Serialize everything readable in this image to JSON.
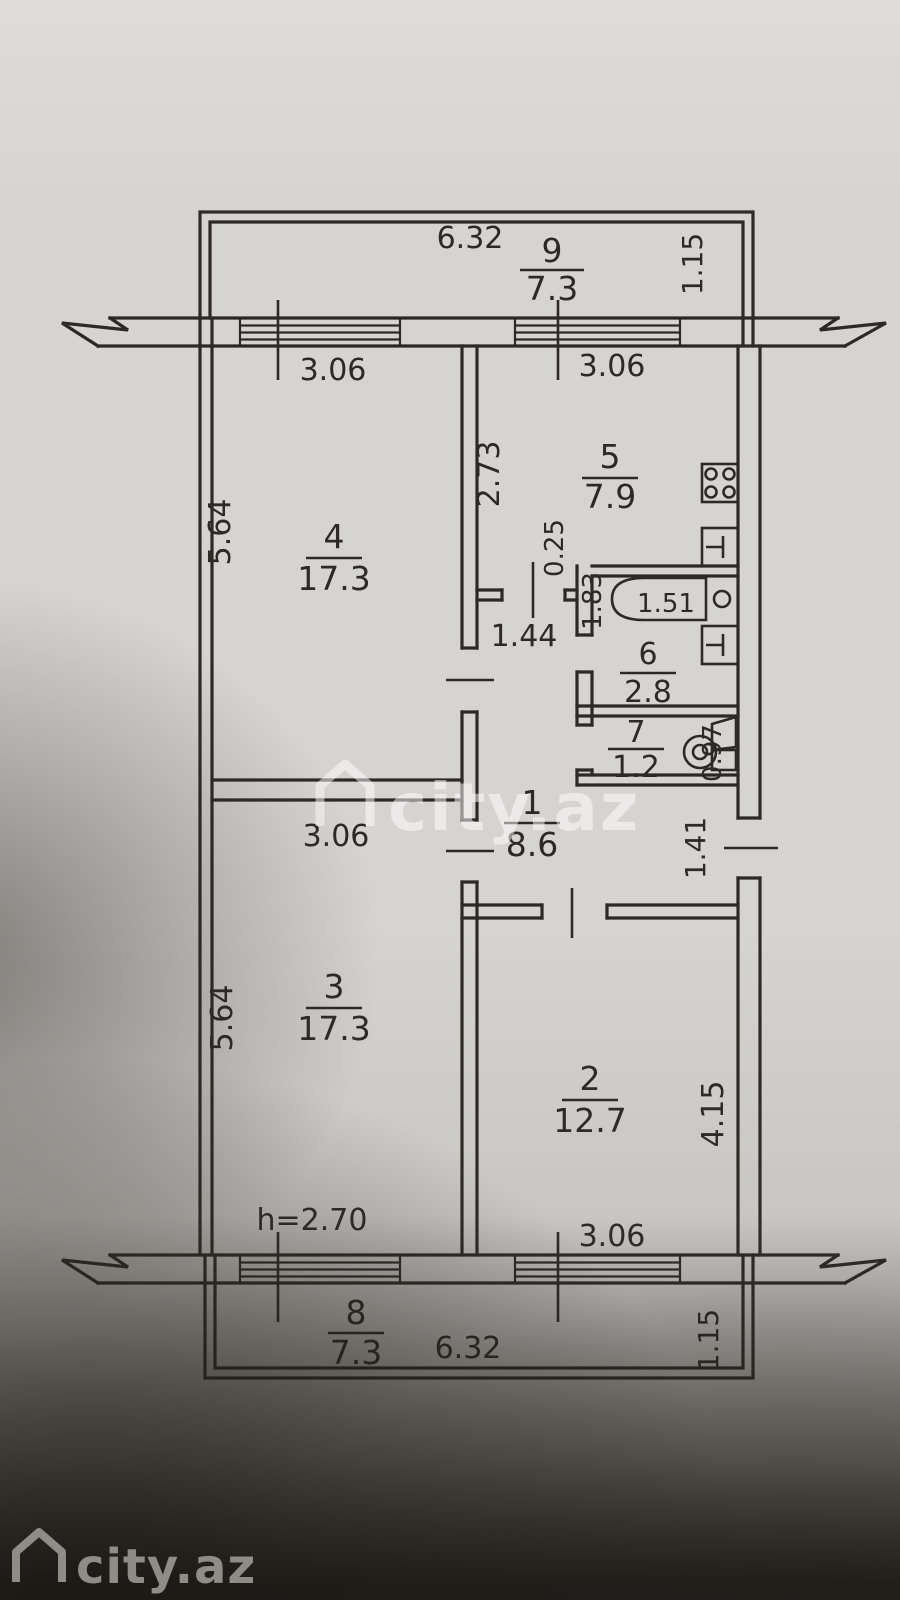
{
  "watermark": {
    "center": "city.az",
    "footer": "city.az"
  },
  "plan": {
    "ceiling_height": "h=2.70",
    "rooms": [
      {
        "no": "1",
        "area": "8.6"
      },
      {
        "no": "2",
        "area": "12.7"
      },
      {
        "no": "3",
        "area": "17.3"
      },
      {
        "no": "4",
        "area": "17.3"
      },
      {
        "no": "5",
        "area": "7.9"
      },
      {
        "no": "6",
        "area": "2.8"
      },
      {
        "no": "7",
        "area": "1.2"
      },
      {
        "no": "8",
        "area": "7.3"
      },
      {
        "no": "9",
        "area": "7.3"
      }
    ],
    "dims": {
      "top_balcony_width": "6.32",
      "top_balcony_depth": "1.15",
      "bottom_balcony_width": "6.32",
      "bottom_balcony_depth": "1.15",
      "room4_window": "3.06",
      "kitchen_window": "3.06",
      "room3_window": "3.06",
      "room2_window": "3.06",
      "room4_depth": "5.64",
      "room3_depth": "5.64",
      "kitchen_depth": "2.73",
      "kitchen_step": "0.25",
      "bathroom_width": "1.83",
      "bathtub_length": "1.51",
      "wc_width": "0.97",
      "corridor_width": "1.44",
      "entry_door_width": "1.41",
      "room2_depth": "4.15"
    }
  }
}
